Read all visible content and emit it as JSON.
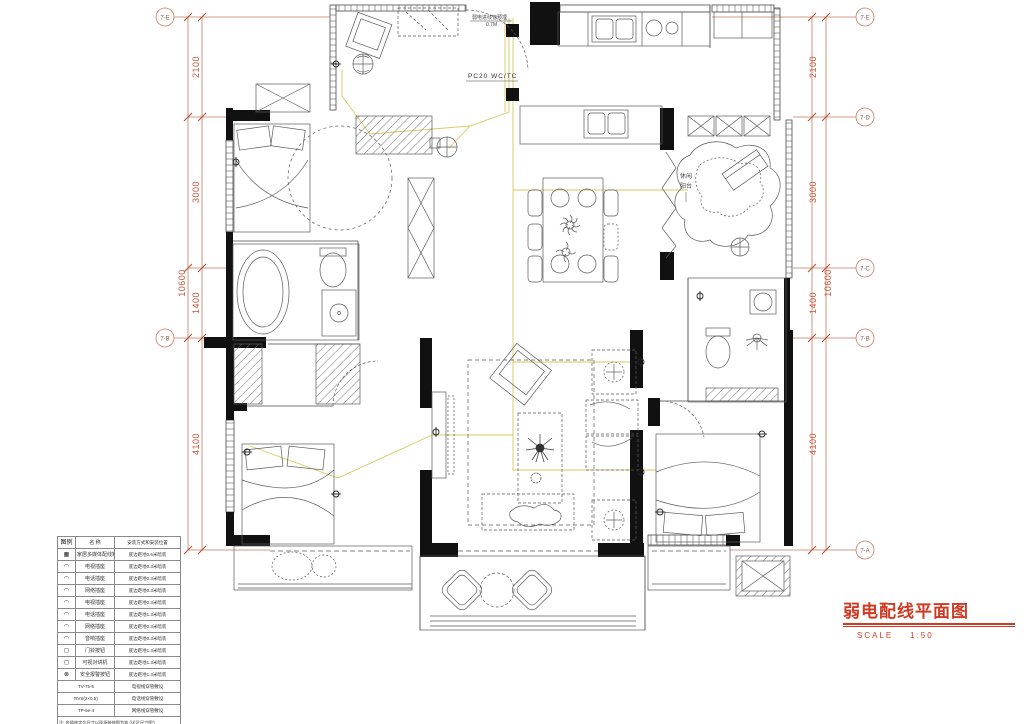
{
  "drawing": {
    "title": "弱电配线平面图",
    "scale_label": "SCALE",
    "scale_value": "1:50"
  },
  "grid": {
    "left_markers": [
      "7-E",
      "7-B"
    ],
    "right_markers": [
      "7-E",
      "7-D",
      "7-C",
      "7-B",
      "7-A"
    ],
    "left_dims": [
      "2100",
      "3000",
      "1400",
      "4100"
    ],
    "right_dims": [
      "2100",
      "3000",
      "1400",
      "4100"
    ],
    "left_overall": "10600",
    "right_overall": "10600"
  },
  "annotations": {
    "entry_note_line1": "弱电进线管预埋",
    "entry_note_line2": "0.7M",
    "riser_label": "PC20  WC/TC",
    "balcony_label_line1": "休闲",
    "balcony_label_line2": "阳台"
  },
  "legend": {
    "headers": [
      "图例",
      "名  称",
      "安装方式和安装位置"
    ],
    "rows": [
      {
        "glyph": "▦",
        "name": "家居多媒体配线箱",
        "install": "底边距地0.5米暗装"
      },
      {
        "glyph": "◠",
        "name": "电视插座",
        "install": "底边距地0.3米暗装"
      },
      {
        "glyph": "◠",
        "name": "电话插座",
        "install": "底边距地0.3米暗装"
      },
      {
        "glyph": "◠",
        "name": "网络插座",
        "install": "底边距地0.3米暗装"
      },
      {
        "glyph": "◠",
        "name": "电视插座",
        "install": "底边距地0.3米暗装"
      },
      {
        "glyph": "◠",
        "name": "电话插座",
        "install": "底边距地1.3米暗装"
      },
      {
        "glyph": "◠",
        "name": "网络插座",
        "install": "底边距地0.3米暗装"
      },
      {
        "glyph": "◠",
        "name": "音响插座",
        "install": "底边距地0.3米暗装"
      },
      {
        "glyph": "◻",
        "name": "门铃按钮",
        "install": "底边距地1.3米暗装"
      },
      {
        "glyph": "◻",
        "name": "可视对讲机",
        "install": "底边距地1.3米暗装"
      },
      {
        "glyph": "⊗",
        "name": "安全报警按钮",
        "install": "底边距地1.3米暗装"
      }
    ],
    "cables": [
      {
        "code": "TV-75-5",
        "desc": "电视线穿管敷设"
      },
      {
        "code": "RVS(2×0.5)",
        "desc": "电话线穿管敷设"
      },
      {
        "code": "TP-5e-4",
        "desc": "网络线穿管敷设"
      }
    ],
    "note": "注: 各插座定位尺寸以现场装修图为准 (详见'尺寸图')"
  }
}
